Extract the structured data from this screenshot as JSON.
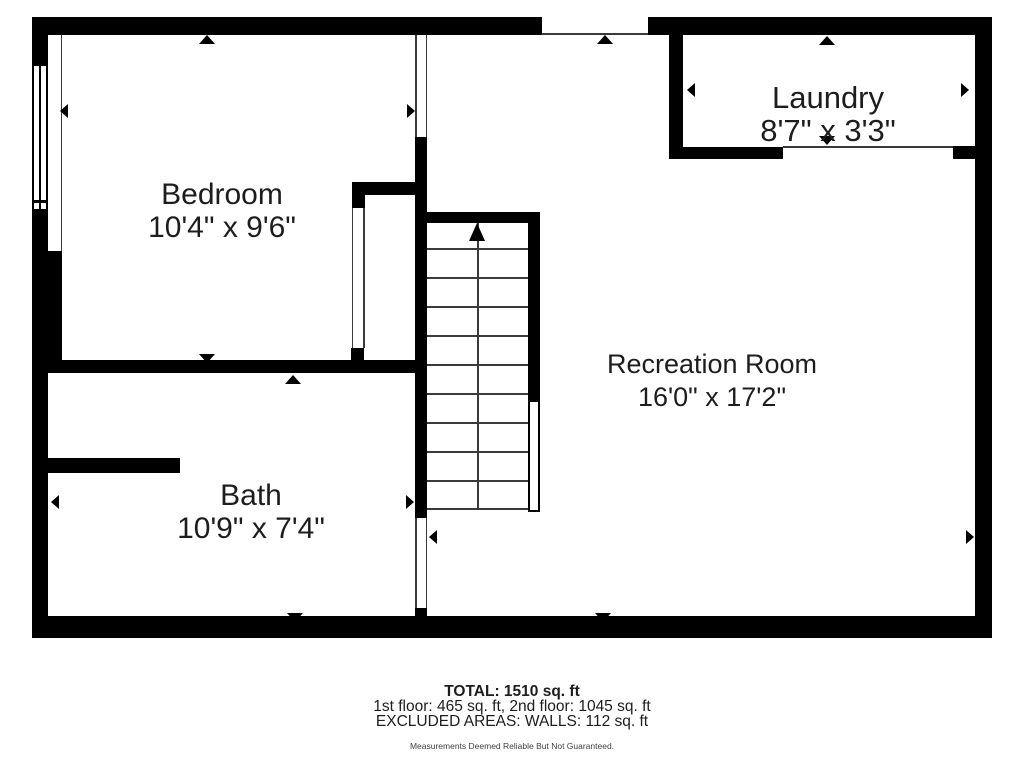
{
  "rooms": [
    {
      "name": "Bedroom",
      "dims": "10'4\" x 9'6\""
    },
    {
      "name": "Laundry",
      "dims": "8'7\" x 3'3\""
    },
    {
      "name": "Bath",
      "dims": "10'9\" x 7'4\""
    },
    {
      "name": "Recreation Room",
      "dims": "16'0\" x 17'2\""
    }
  ],
  "stairs": {
    "treads": 10,
    "direction_arrow": "up"
  },
  "summary": {
    "total": "TOTAL: 1510 sq. ft",
    "floors": "1st floor: 465 sq. ft, 2nd floor: 1045 sq. ft",
    "excluded": "EXCLUDED AREAS: WALLS: 112 sq. ft",
    "disclaimer": "Measurements Deemed Reliable But Not Guaranteed."
  },
  "colors": {
    "wall": "#000000",
    "text": "#1d1d1d",
    "thin_line": "#3a3a3a",
    "background": "#ffffff"
  }
}
